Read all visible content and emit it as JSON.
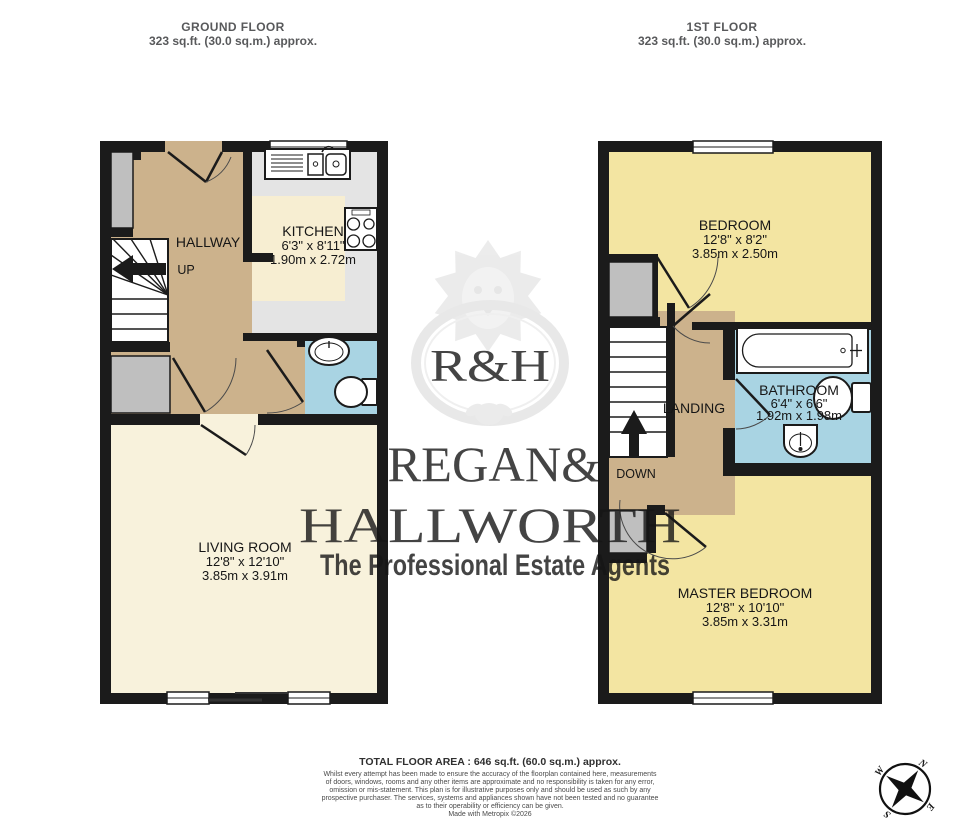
{
  "floors": {
    "ground": {
      "title": "GROUND FLOOR",
      "area": "323 sq.ft. (30.0 sq.m.) approx."
    },
    "first": {
      "title": "1ST FLOOR",
      "area": "323 sq.ft. (30.0 sq.m.) approx."
    }
  },
  "rooms": {
    "hallway": {
      "name": "HALLWAY"
    },
    "kitchen": {
      "name": "KITCHEN",
      "imperial": "6'3\" x 8'11\"",
      "metric": "1.90m x 2.72m"
    },
    "living_room": {
      "name": "LIVING ROOM",
      "imperial": "12'8\" x 12'10\"",
      "metric": "3.85m x 3.91m"
    },
    "bedroom": {
      "name": "BEDROOM",
      "imperial": "12'8\" x 8'2\"",
      "metric": "3.85m x 2.50m"
    },
    "bathroom": {
      "name": "BATHROOM",
      "imperial": "6'4\" x 6'6\"",
      "metric": "1.92m x 1.98m"
    },
    "landing": {
      "name": "LANDING"
    },
    "master_bedroom": {
      "name": "MASTER BEDROOM",
      "imperial": "12'8\" x 10'10\"",
      "metric": "3.85m x 3.31m"
    }
  },
  "stairs": {
    "up": "UP",
    "down": "DOWN"
  },
  "watermark": {
    "monogram": "R&H",
    "name_line1": "REGAN&",
    "name_line2": "HALLWORTH",
    "tagline": "The Professional Estate Agents"
  },
  "compass": {
    "north": "N",
    "east": "E",
    "south": "S",
    "west": "W"
  },
  "footer": {
    "total_area": "TOTAL FLOOR AREA : 646 sq.ft. (60.0 sq.m.) approx.",
    "disclaimer_lines": [
      "Whilst every attempt has been made to ensure the accuracy of the floorplan contained here, measurements",
      "of doors, windows, rooms and any other items are approximate and no responsibility is taken for any error,",
      "omission or mis-statement. This plan is for illustrative purposes only and should be used as such by any",
      "prospective purchaser. The services, systems and appliances shown have not been tested and no guarantee",
      "as to their operability or efficiency can be given."
    ],
    "credit": "Made with Metropix ©2026"
  },
  "colors": {
    "wall": "#1b1b1b",
    "hall_tan": "#ccb28c",
    "kitchen_floor": "#f7eed2",
    "living_floor": "#f8f2dc",
    "bedroom_yellow": "#f3e5a2",
    "bath_blue": "#a9d4e3",
    "closet_gray": "#bfbfbf",
    "counter_gray": "#e4e4e4"
  }
}
